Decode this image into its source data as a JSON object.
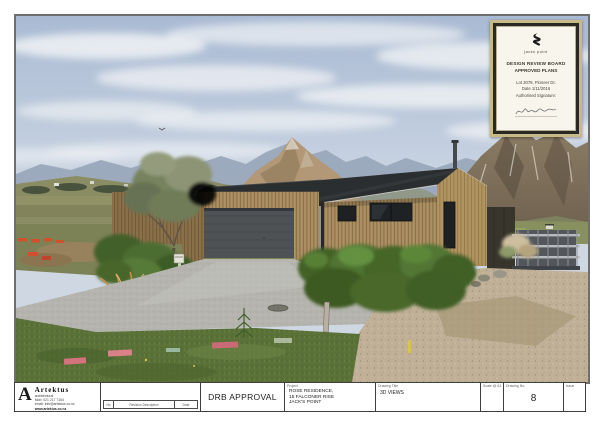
{
  "stamp": {
    "brand": "jacks point",
    "board_line1": "DESIGN REVIEW BOARD",
    "board_line2": "APPROVED PLANS",
    "lot": "Lot 2079, Pioneer Dr.",
    "date": "Date 1/11/2016",
    "auth": "Authorised Signature:"
  },
  "title_block": {
    "firm": {
      "name": "Artektus",
      "tagline": "architectural",
      "phone": "Mob:  021 217 7164",
      "email": "email: info@artektus.co.nz",
      "web": "www.artektus.co.nz"
    },
    "revision_strip": {
      "no_label": "No",
      "desc_label": "Revision Description",
      "date_label": "Date"
    },
    "approval": "DRB APPROVAL",
    "project": {
      "label": "Project",
      "line1": "ROSE RESIDENCE,",
      "line2": "15 FALCONER RISE",
      "line3": "JACK'S POINT"
    },
    "drawing": {
      "label": "Drawing Title",
      "value": "3D VIEWS"
    },
    "scale": {
      "label": "Scale @ A3"
    },
    "number": {
      "label": "Drawing No.",
      "value": "8"
    },
    "issue": {
      "label": "Issue"
    }
  },
  "scene": {
    "type": "architectural-3d-render",
    "subject": "Single-storey cedar-clad house with black gable roof and double garage, hedges, olive tree, tussock grasses, gravel driveway, mountain backdrop at Jack's Point",
    "colors": {
      "sky": "#b0c0d7",
      "cloud": "#eef1f4",
      "far_range": "#9aa8ba",
      "tan_peak": "#b29877",
      "right_massif": "#776854",
      "hills": "#85885e",
      "roof": "#2b2e30",
      "cedar": "#a68b5e",
      "garage_door": "#4e5255",
      "hedge": "#46682c",
      "grass": "#5a7138",
      "gravel": "#b5b4ae",
      "sand": "#c0b097",
      "survey_mark": "#d4737e"
    }
  }
}
